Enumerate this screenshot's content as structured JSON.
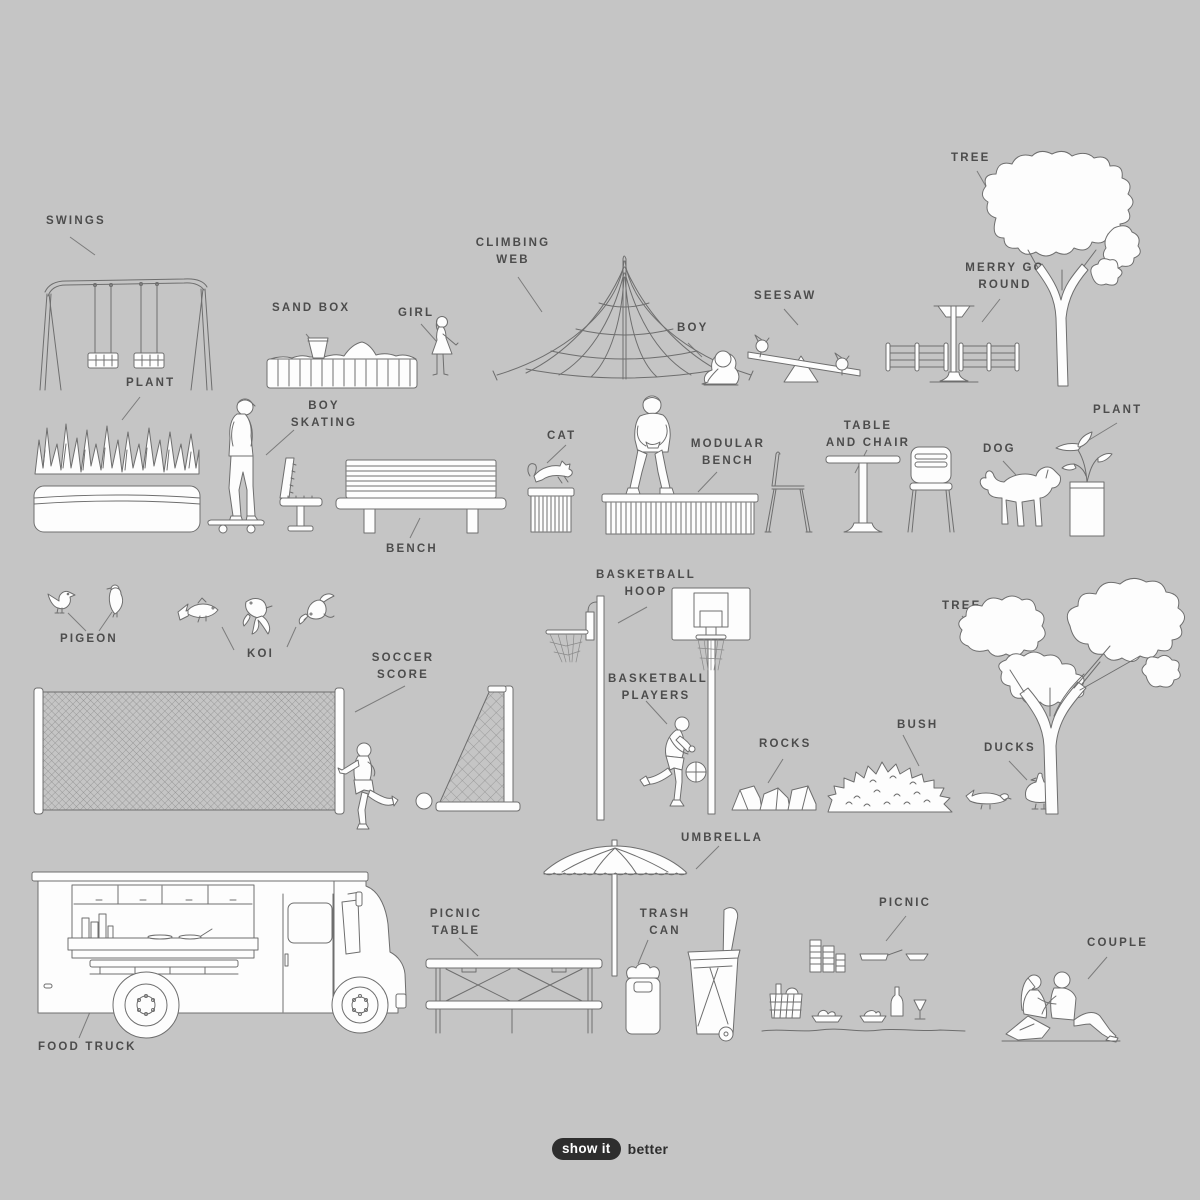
{
  "poster": {
    "background_color": "#c5c5c5",
    "line_color": "#6e6e6e",
    "fill_color": "#fdfdfd",
    "label_color": "#4c4c4c",
    "logo_color": "#2e2e2e"
  },
  "labels": {
    "swings": "SWINGS",
    "plant_left": "PLANT",
    "sand_box": "SAND BOX",
    "girl": "GIRL",
    "climbing_web": "CLIMBING\nWEB",
    "boy": "BOY",
    "seesaw": "SEESAW",
    "merry_go_round": "MERRY GO\nROUND",
    "tree_top": "TREE",
    "boy_skating": "BOY\nSKATING",
    "bench": "BENCH",
    "cat": "CAT",
    "modular_bench": "MODULAR\nBENCH",
    "table_and_chair": "TABLE\nAND CHAIR",
    "dog": "DOG",
    "plant_right": "PLANT",
    "pigeon": "PIGEON",
    "koi": "KOI",
    "soccer_score": "SOCCER\nSCORE",
    "basketball_hoop": "BASKETBALL\nHOOP",
    "basketball_players": "BASKETBALL\nPLAYERS",
    "rocks": "ROCKS",
    "bush": "BUSH",
    "ducks": "DUCKS",
    "tree_right": "TREE",
    "food_truck": "FOOD TRUCK",
    "picnic_table": "PICNIC\nTABLE",
    "umbrella": "UMBRELLA",
    "trash_can": "TRASH\nCAN",
    "picnic": "PICNIC",
    "couple": "COUPLE"
  },
  "logo": {
    "badge": "show it",
    "suffix": "better"
  }
}
